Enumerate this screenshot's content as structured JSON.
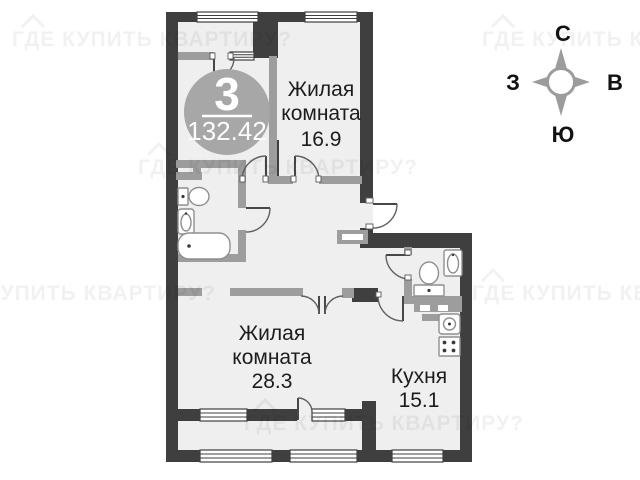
{
  "watermark": {
    "text": "ГДЕ КУПИТЬ КВАРТИРУ?"
  },
  "badge": {
    "room_count": "3",
    "total_area": "132.42"
  },
  "rooms": {
    "living1": {
      "line1": "Жилая",
      "line2": "комната",
      "area": "16.9"
    },
    "living2": {
      "line1": "Жилая",
      "line2": "комната",
      "area": "28.3"
    },
    "kitchen": {
      "name": "Кухня",
      "area": "15.1"
    }
  },
  "compass": {
    "north": "С",
    "south": "Ю",
    "west": "З",
    "east": "В"
  },
  "colors": {
    "wall_dark": "#3f3f3f",
    "wall_light": "#9d9d9d",
    "floor": "#efefef",
    "badge_fill": "#a7a7a7",
    "label_text": "#1c1c1c"
  }
}
